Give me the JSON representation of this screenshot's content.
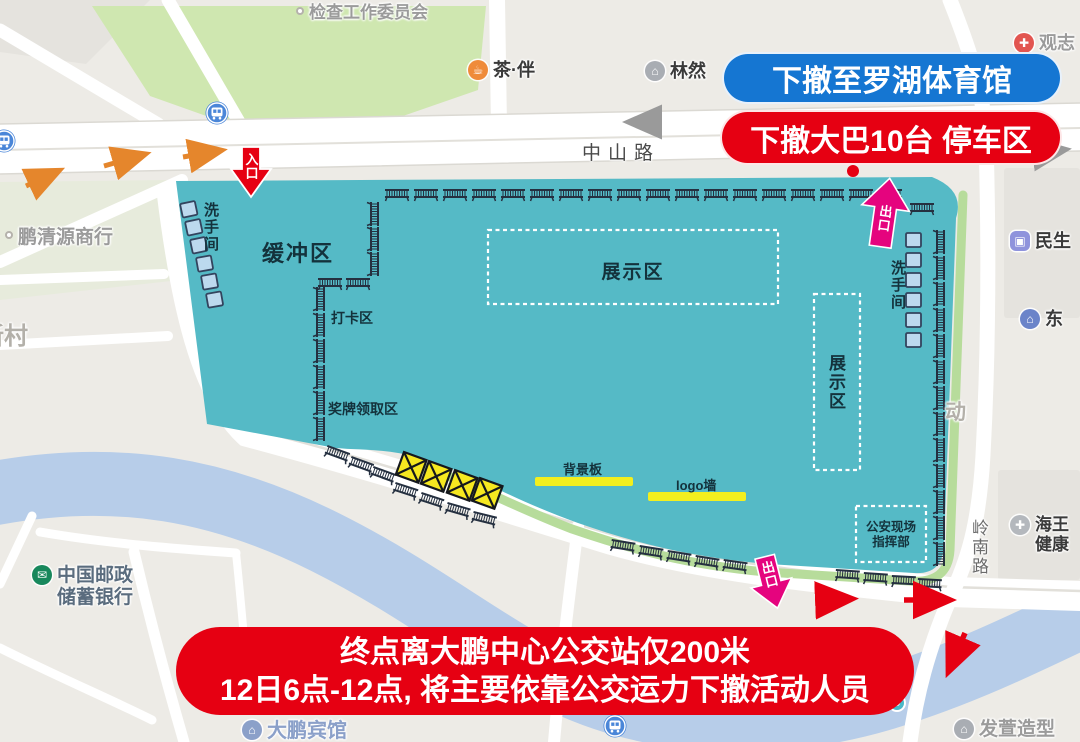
{
  "annotations": {
    "evacuate_banner": "下撤至罗湖体育馆",
    "bus_banner": "下撤大巴10台 停车区",
    "bottom_banner_line1": "终点离大鹏中心公交站仅200米",
    "bottom_banner_line2": "12日6点-12点, 将主要依靠公交运力下撤活动人员",
    "entrance_label": "入口",
    "exit_label_top": "出口",
    "exit_label_bottom": "出口"
  },
  "venue_labels": {
    "buffer_zone": "缓冲区",
    "restroom_left": "洗手间",
    "restroom_right": "洗手间",
    "checkin_area": "打卡区",
    "medal_area": "奖牌领取区",
    "exhibition_center": "展示区",
    "exhibition_right": "展示区",
    "backdrop_board": "背景板",
    "logo_wall": "logo墙",
    "police_line1": "公安现场",
    "police_line2": "指挥部"
  },
  "road_labels": {
    "zhongshan_road": "中山路",
    "lingnan_road": "岭南路"
  },
  "colors": {
    "venue": "#55bac6",
    "venue_edge": "#b7dc9b",
    "banner_blue": "#1576d2",
    "banner_red": "#e60012",
    "exit_pink": "#e5047e",
    "arrow_orange": "#e5862c",
    "river": "#b7cde9",
    "park_green": "#cfe7b0",
    "highlight_yellow": "#f3ef1e",
    "barrier": "#253040"
  },
  "icon_glyphs": {
    "tea": "☕",
    "bld": "⌂",
    "cross": "✚",
    "bag": "▣",
    "pill": "✚",
    "post": "✉",
    "dot": ""
  },
  "pois": [
    {
      "name": "poi-inspection-committee",
      "icon": "dot",
      "ibg": "#ffffff",
      "x": 296,
      "y": 3,
      "lines": [
        "检查工作委员会"
      ],
      "color": "#9b9b9b",
      "size": 17
    },
    {
      "name": "poi-tea-ban",
      "icon": "tea",
      "ibg": "#ef8b3a",
      "x": 468,
      "y": 60,
      "lines": [
        "茶·伴"
      ],
      "color": "#3a3a3a",
      "size": 18
    },
    {
      "name": "poi-linran",
      "icon": "bld",
      "ibg": "#a9adb3",
      "x": 645,
      "y": 61,
      "lines": [
        "林然"
      ],
      "color": "#3a3a3a",
      "size": 18
    },
    {
      "name": "poi-guanzhi",
      "icon": "cross",
      "ibg": "#e25550",
      "x": 1014,
      "y": 33,
      "lines": [
        "观志"
      ],
      "color": "#9b9b9b",
      "size": 18
    },
    {
      "name": "poi-pengqingyuan",
      "icon": "dot",
      "ibg": "#ffffff",
      "x": 5,
      "y": 227,
      "lines": [
        "鹏清源商行"
      ],
      "color": "#9b9b9b",
      "size": 19
    },
    {
      "name": "poi-minsheng",
      "icon": "bag",
      "ibg": "#8f93dc",
      "x": 1010,
      "y": 231,
      "lines": [
        "民生"
      ],
      "color": "#3a3a3a",
      "size": 18
    },
    {
      "name": "poi-dong-bank",
      "icon": "bld",
      "ibg": "#6b84c9",
      "x": 1020,
      "y": 309,
      "lines": [
        "东"
      ],
      "color": "#3a3a3a",
      "size": 18
    },
    {
      "name": "poi-haiwang-health",
      "icon": "pill",
      "ibg": "#b4b8bd",
      "x": 1010,
      "y": 515,
      "lines": [
        "海王",
        "健康"
      ],
      "color": "#3a3a3a",
      "size": 17
    },
    {
      "name": "poi-china-post",
      "icon": "post",
      "ibg": "#18885c",
      "x": 32,
      "y": 565,
      "lines": [
        "中国邮政",
        "储蓄银行"
      ],
      "color": "#5a6c7e",
      "size": 19
    },
    {
      "name": "poi-dapeng-hotel",
      "icon": "bld",
      "ibg": "#8ba0c9",
      "x": 242,
      "y": 720,
      "lines": [
        "大鹏宾馆"
      ],
      "color": "#8ba0c9",
      "size": 20
    },
    {
      "name": "poi-fa-salon",
      "icon": "bld",
      "ibg": "#a9adb3",
      "x": 954,
      "y": 719,
      "lines": [
        "发萱造型"
      ],
      "color": "#9b9b9b",
      "size": 19
    },
    {
      "name": "poi-xincun",
      "x": -20,
      "y": 323,
      "lines": [
        "新村"
      ],
      "color": "#b3b0a9",
      "size": 24
    },
    {
      "name": "poi-dong-char",
      "x": 945,
      "y": 401,
      "lines": [
        "动"
      ],
      "color": "#b3b0a9",
      "size": 21
    }
  ],
  "map_glyphs": {
    "barriers": [
      [
        385,
        188
      ],
      [
        414,
        188
      ],
      [
        443,
        188
      ],
      [
        472,
        188
      ],
      [
        501,
        188
      ],
      [
        530,
        188
      ],
      [
        559,
        188
      ],
      [
        588,
        188
      ],
      [
        617,
        188
      ],
      [
        646,
        188
      ],
      [
        675,
        188
      ],
      [
        704,
        188
      ],
      [
        733,
        188
      ],
      [
        762,
        188
      ],
      [
        791,
        188
      ],
      [
        820,
        188
      ],
      [
        849,
        188
      ],
      [
        878,
        188
      ],
      [
        910,
        202
      ],
      [
        380,
        202,
        90
      ],
      [
        380,
        227,
        90
      ],
      [
        380,
        252,
        90
      ],
      [
        318,
        277
      ],
      [
        346,
        277
      ],
      [
        326,
        287,
        90
      ],
      [
        326,
        313,
        90
      ],
      [
        326,
        339,
        90
      ],
      [
        326,
        365,
        90
      ],
      [
        326,
        391,
        90
      ],
      [
        326,
        417,
        90
      ],
      [
        328,
        444,
        20
      ],
      [
        352,
        455,
        20
      ],
      [
        374,
        465,
        20
      ],
      [
        396,
        481,
        18
      ],
      [
        422,
        491,
        18
      ],
      [
        448,
        501,
        16
      ],
      [
        474,
        510,
        14
      ],
      [
        612,
        538,
        9
      ],
      [
        640,
        544,
        9
      ],
      [
        668,
        549,
        9
      ],
      [
        696,
        554,
        9
      ],
      [
        724,
        558,
        8
      ],
      [
        836,
        568,
        4
      ],
      [
        864,
        571,
        4
      ],
      [
        892,
        574,
        3
      ],
      [
        918,
        577,
        3
      ],
      [
        946,
        230,
        90
      ],
      [
        946,
        256,
        90
      ],
      [
        946,
        282,
        90
      ],
      [
        946,
        308,
        90
      ],
      [
        946,
        334,
        90
      ],
      [
        946,
        360,
        90
      ],
      [
        946,
        386,
        90
      ],
      [
        946,
        412,
        90
      ],
      [
        946,
        438,
        90
      ],
      [
        946,
        464,
        90
      ],
      [
        946,
        490,
        90
      ],
      [
        946,
        516,
        90
      ],
      [
        946,
        542,
        90
      ]
    ],
    "toilets": [
      [
        180,
        204,
        -12
      ],
      [
        185,
        222,
        -12
      ],
      [
        190,
        240,
        -12
      ],
      [
        196,
        258,
        -10
      ],
      [
        201,
        276,
        -10
      ],
      [
        206,
        294,
        -10
      ],
      [
        906,
        233
      ],
      [
        906,
        253
      ],
      [
        906,
        273
      ],
      [
        906,
        293
      ],
      [
        906,
        313
      ],
      [
        906,
        333
      ]
    ],
    "closed_boxes": [
      [
        404,
        452,
        20
      ],
      [
        429,
        461,
        20
      ],
      [
        455,
        470,
        20
      ],
      [
        480,
        478,
        20
      ]
    ],
    "metro_stations": [
      [
        217,
        113
      ],
      [
        4,
        141
      ],
      [
        925,
        601
      ],
      [
        615,
        726
      ]
    ],
    "bus_stops": [
      [
        897,
        703
      ]
    ]
  }
}
